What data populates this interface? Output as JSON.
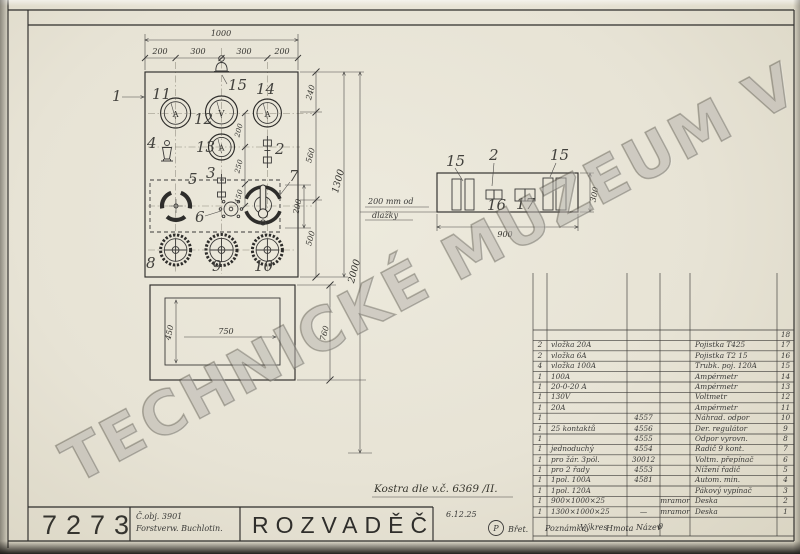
{
  "watermark": "TECHNICKÉ MUZEUM V BRNĚ",
  "front": {
    "callouts": {
      "c1": "1",
      "c2": "2",
      "c3": "3",
      "c4": "4",
      "c5": "5",
      "c6": "6",
      "c7": "7",
      "c8": "8",
      "c9": "9",
      "c10": "10",
      "c11": "11",
      "c12": "12",
      "c13": "13",
      "c14": "14",
      "c15": "15"
    },
    "meter_letters": {
      "m11": "A",
      "m12": "V",
      "m13": "A",
      "m14": "A"
    },
    "dims": {
      "w_total": "1000",
      "w_seg_1": "200",
      "w_seg_2": "300",
      "w_seg_3": "300",
      "w_seg_4": "200",
      "h_240": "240",
      "h_560": "560",
      "h_500": "500",
      "h_760": "760",
      "h_1300": "1300",
      "h_2000": "2000",
      "i_200": "200",
      "i_250": "250",
      "i_150": "150",
      "s_200": "200",
      "door_w": "750",
      "door_h": "450"
    }
  },
  "plan": {
    "callouts": {
      "c15l": "15",
      "c2": "2",
      "c15r": "15",
      "c16": "16",
      "c17": "17"
    },
    "dims": {
      "w": "900",
      "d": "300"
    },
    "note_line1": "200 mm od",
    "note_line2": "dlažky"
  },
  "annotations": {
    "kostra": "Kostra dle v.č. 6369 /II."
  },
  "title_block": {
    "drawing_number": "7273",
    "order_no": "Č.obj. 3901",
    "customer": "Forstverw. Buchlotin.",
    "title": "ROZVADĚČ",
    "date": "6.12.25",
    "stamp": "P",
    "sig": "Břet."
  },
  "table": {
    "footer": {
      "note": "Poznámka",
      "dwg": "Výkres",
      "mat": "Hmota",
      "name": "Název",
      "zero": "0"
    },
    "rows": [
      {
        "qty": "",
        "spec": "",
        "dwg": "",
        "mat": "",
        "name": "",
        "no": "18"
      },
      {
        "qty": "2",
        "spec": "vložka 20A",
        "dwg": "",
        "mat": "",
        "name": "Pojistka T425",
        "no": "17"
      },
      {
        "qty": "2",
        "spec": "vložka 6A",
        "dwg": "",
        "mat": "",
        "name": "Pojistka T2 15",
        "no": "16"
      },
      {
        "qty": "4",
        "spec": "vložka 100A",
        "dwg": "",
        "mat": "",
        "name": "Trubk. poj. 120A",
        "no": "15"
      },
      {
        "qty": "1",
        "spec": "100A",
        "dwg": "",
        "mat": "",
        "name": "Ampérmetr",
        "no": "14"
      },
      {
        "qty": "1",
        "spec": "20-0-20 A",
        "dwg": "",
        "mat": "",
        "name": "Ampérmetr",
        "no": "13"
      },
      {
        "qty": "1",
        "spec": "130V",
        "dwg": "",
        "mat": "",
        "name": "Voltmetr",
        "no": "12"
      },
      {
        "qty": "1",
        "spec": "20A",
        "dwg": "",
        "mat": "",
        "name": "Ampérmetr",
        "no": "11"
      },
      {
        "qty": "1",
        "spec": "",
        "dwg": "4557",
        "mat": "",
        "name": "Náhrad. odpor",
        "no": "10"
      },
      {
        "qty": "1",
        "spec": "25 kontaktů",
        "dwg": "4556",
        "mat": "",
        "name": "Der. regulátor",
        "no": "9"
      },
      {
        "qty": "1",
        "spec": "",
        "dwg": "4555",
        "mat": "",
        "name": "Odpor vyrovn.",
        "no": "8"
      },
      {
        "qty": "1",
        "spec": "jednoduchý",
        "dwg": "4554",
        "mat": "",
        "name": "Řadič 9 kont.",
        "no": "7"
      },
      {
        "qty": "1",
        "spec": "pro žár. 3pól.",
        "dwg": "30012",
        "mat": "",
        "name": "Voltm. přepínač",
        "no": "6"
      },
      {
        "qty": "1",
        "spec": "pro 2 řady",
        "dwg": "4553",
        "mat": "",
        "name": "Nížení řadič",
        "no": "5"
      },
      {
        "qty": "1",
        "spec": "1pol. 100A",
        "dwg": "4581",
        "mat": "",
        "name": "Autom. min.",
        "no": "4"
      },
      {
        "qty": "1",
        "spec": "1pol. 120A",
        "dwg": "",
        "mat": "",
        "name": "Pákový vypínač",
        "no": "3"
      },
      {
        "qty": "1",
        "spec": "900×1000×25",
        "dwg": "",
        "mat": "mramor",
        "name": "Deska",
        "no": "2"
      },
      {
        "qty": "1",
        "spec": "1300×1000×25",
        "dwg": "—",
        "mat": "mramor",
        "name": "Deska",
        "no": "1"
      }
    ]
  }
}
